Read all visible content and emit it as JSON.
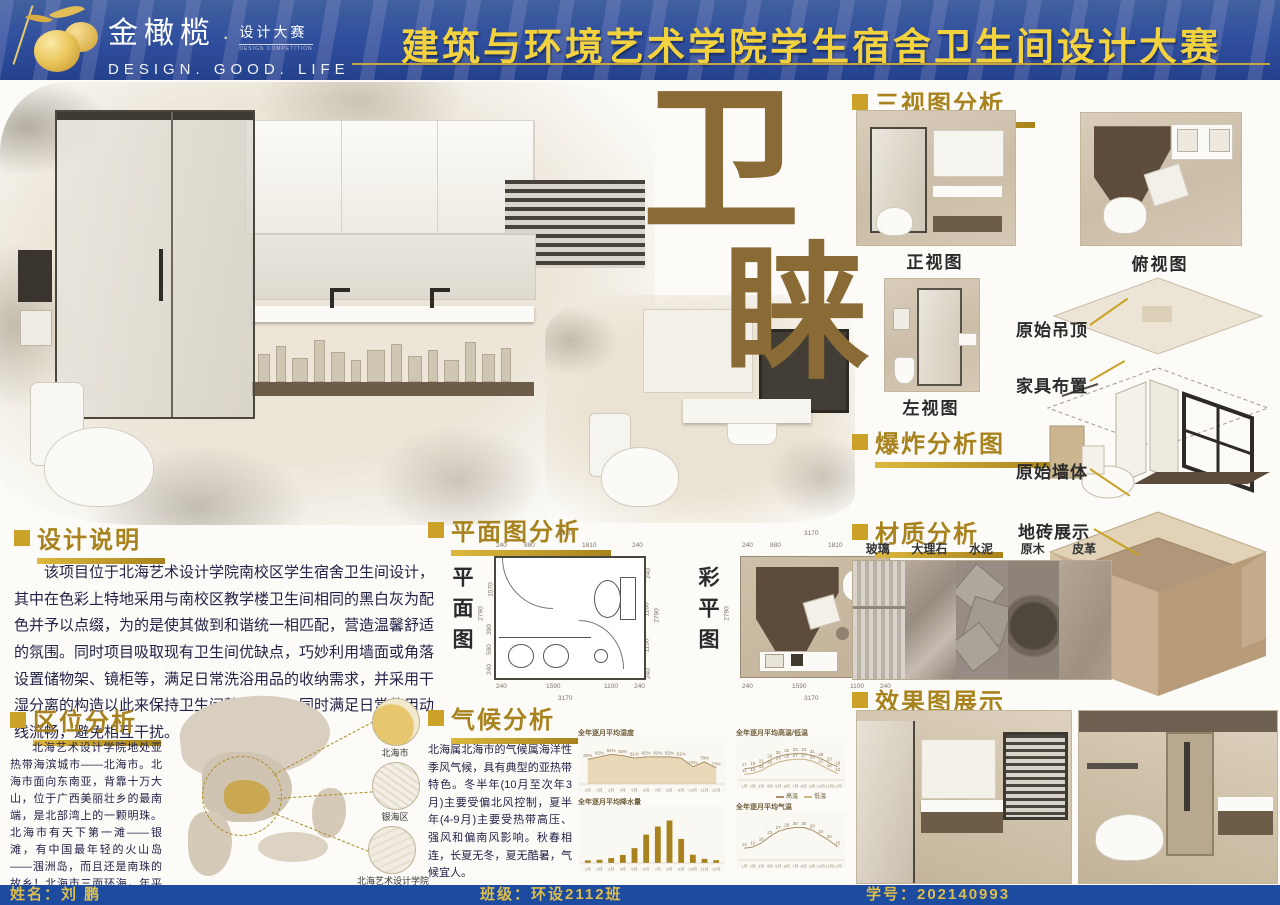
{
  "header": {
    "brand_cn": "金橄榄",
    "brand_dot": "·",
    "brand_sub": "设计大赛",
    "brand_sub_en": "DESIGN COMPETITION",
    "brand_en": "DESIGN.  GOOD.  LIFE",
    "title": "建筑与环境艺术学院学生宿舍卫生间设计大赛"
  },
  "hero": {
    "char_top": "卫",
    "char_bottom": "睐"
  },
  "design_note": {
    "heading": "设计说明",
    "body": "该项目位于北海艺术设计学院南校区学生宿舍卫生间设计，其中在色彩上特地采用与南校区教学楼卫生间相同的黑白灰为配色并予以点缀，为的是使其做到和谐统一相匹配，营造温馨舒适的氛围。同时项目吸取现有卫生间优缺点，巧妙利用墙面或角落设置储物架、镜柜等，满足日常洗浴用品的收纳需求，并采用干湿分离的构造以此来保持卫生间整洁有序。同时满足日常使用动线流畅，避免相互干扰。"
  },
  "location": {
    "heading": "区位分析",
    "body": "北海艺术设计学院地处亚热带海滨城市——北海市。北海市面向东南亚，背靠十万大山，位于广西美丽壮乡的最南端，是北部湾上的一颗明珠。北海市有天下第一滩——银滩，有中国最年轻的火山岛——涠洲岛，而且还是南珠的故乡！北海市三面环海，年平均温度22度，不仅风光秀美，还是天然氧吧，被评为中国最适合人居的城市！",
    "callouts": [
      "北海市",
      "银海区",
      "北海艺术设计学院"
    ]
  },
  "plan": {
    "heading": "平面图分析",
    "left_label": "平面图",
    "right_label": "彩平图",
    "dims": {
      "top_total": "3170",
      "top_segs": [
        "240",
        "880",
        "1810",
        "240"
      ],
      "left_total": "2790",
      "left_segs": [
        "1570",
        "390",
        "590",
        "240"
      ],
      "right_total": "2790",
      "right_segs": [
        "240",
        "1160",
        "1150",
        "240"
      ],
      "bottom_segs": [
        "240",
        "1590",
        "1100",
        "240"
      ],
      "bottom_total": "3170"
    }
  },
  "climate": {
    "heading": "气候分析",
    "body": "北海属北海市的气候属海洋性季风气候，具有典型的亚热带特色。冬半年(10月至次年3月)主要受偏北风控制，夏半年(4-9月)主要受热带高压、强风和偏南风影响。秋春相连，长夏无冬，夏无酷暑，气候宜人。",
    "legend": [
      "高温",
      "低温"
    ]
  },
  "chart_data": [
    {
      "type": "area",
      "title": "全年逐月平均湿度",
      "x": [
        "1月",
        "2月",
        "3月",
        "4月",
        "5月",
        "6月",
        "7月",
        "8月",
        "9月",
        "10月",
        "11月",
        "12月"
      ],
      "values": [
        80,
        82,
        84,
        83,
        81,
        82,
        82,
        82,
        81,
        74,
        78,
        73
      ],
      "unit": "%",
      "ylim": [
        60,
        90
      ]
    },
    {
      "type": "bar",
      "title": "全年逐月平均降水量",
      "x": [
        "1月",
        "2月",
        "3月",
        "4月",
        "5月",
        "6月",
        "7月",
        "8月",
        "9月",
        "10月",
        "11月",
        "12月"
      ],
      "values": [
        28,
        34,
        52,
        86,
        158,
        302,
        388,
        452,
        256,
        88,
        44,
        30
      ],
      "ylim": [
        0,
        500
      ]
    },
    {
      "type": "line",
      "title": "全年逐月平均高温/低温",
      "x": [
        "1月",
        "2月",
        "3月",
        "4月",
        "5月",
        "6月",
        "7月",
        "8月",
        "9月",
        "10月",
        "11月",
        "12月"
      ],
      "series": [
        {
          "name": "高温",
          "values": [
            17,
            18,
            21,
            26,
            30,
            32,
            33,
            33,
            31,
            28,
            23,
            19
          ]
        },
        {
          "name": "低温",
          "values": [
            11,
            12,
            15,
            20,
            24,
            26,
            27,
            27,
            25,
            21,
            16,
            12
          ]
        }
      ],
      "ylim": [
        5,
        40
      ]
    },
    {
      "type": "line",
      "title": "全年逐月平均气温",
      "x": [
        "1月",
        "2月",
        "3月",
        "4月",
        "5月",
        "6月",
        "7月",
        "8月",
        "9月",
        "10月",
        "11月",
        "12月"
      ],
      "values": [
        14,
        15,
        18,
        23,
        27,
        29,
        30,
        30,
        28,
        24,
        20,
        15
      ],
      "ylim": [
        5,
        35
      ]
    }
  ],
  "three_views": {
    "heading": "三视图分析",
    "front": "正视图",
    "top": "俯视图",
    "left": "左视图"
  },
  "exploded": {
    "heading": "爆炸分析图",
    "labels": [
      "原始吊顶",
      "家具布置",
      "原始墙体",
      "地砖展示"
    ]
  },
  "materials": {
    "heading": "材质分析",
    "items": [
      "玻璃",
      "大理石",
      "水泥",
      "原木",
      "皮革"
    ]
  },
  "renders": {
    "heading": "效果图展示"
  },
  "footer": {
    "name": "姓名：刘 鹏",
    "class": "班级：环设2112班",
    "sid": "学号：202140993"
  },
  "colors": {
    "header_blue": "#2a4da0",
    "footer_blue": "#1c4ba0",
    "gold": "#c9a227",
    "title_yellow": "#f2d23e",
    "hero_brown": "#8a6b35",
    "text": "#232347"
  }
}
